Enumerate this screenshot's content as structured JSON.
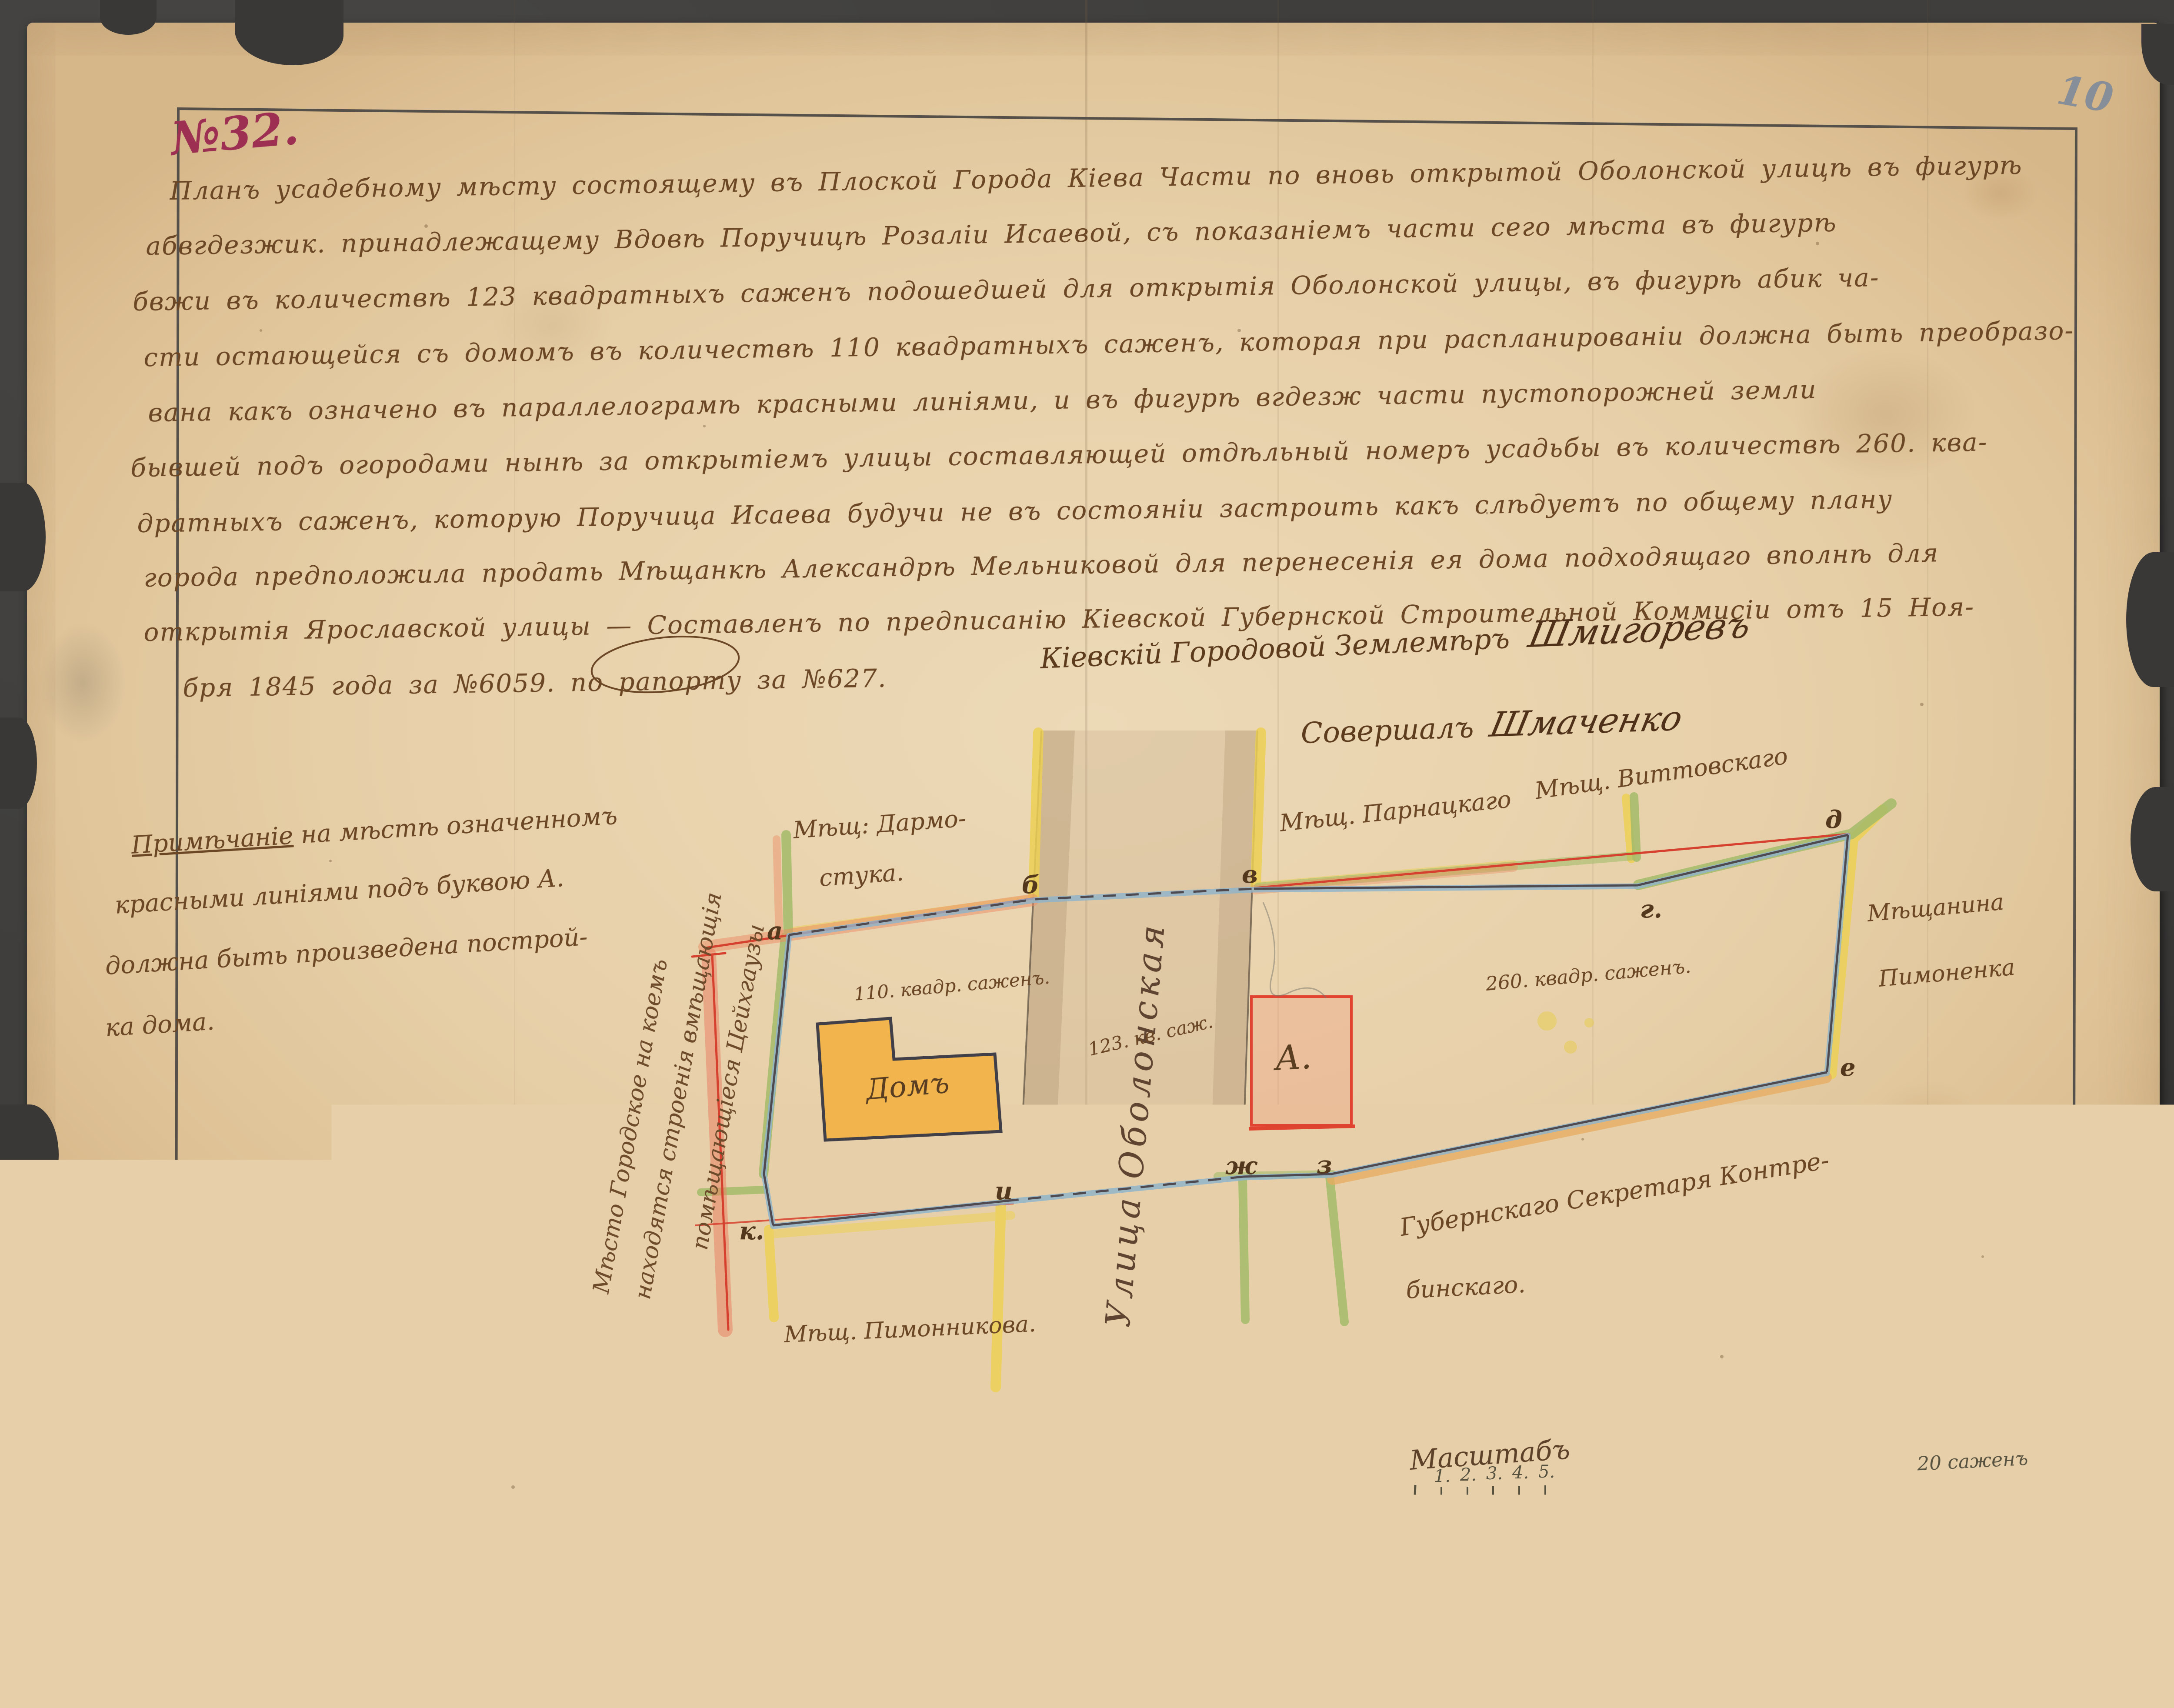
{
  "page": {
    "number": "10",
    "registry_number": "№32.",
    "pencil_bottom_left_1": "З",
    "pencil_bottom_left_2": "20"
  },
  "document": {
    "body_lines": [
      "Планъ усадебному мѣсту состоящему въ Плоской Города Кіева Части по вновь открытой Оболонской улицѣ въ фигурѣ",
      "абвгдезжик. принадлежащему Вдовѣ Поручицѣ Розаліи Исаевой, съ показаніемъ части сего мѣста въ фигурѣ",
      "бвжи въ количествѣ 123 квадратныхъ саженъ подошедшей для открытія Оболонской улицы, въ фигурѣ абик ча-",
      "сти остающейся съ домомъ въ количествѣ 110 квадратныхъ саженъ, которая при распланированіи должна быть преобразо-",
      "вана какъ означено въ параллелограмѣ красными линіями, и въ фигурѣ вгдезж части пустопорожней земли",
      "бывшей подъ огородами нынѣ за открытіемъ улицы составляющей отдѣльный номеръ усадьбы въ количествѣ 260. ква-",
      "дратныхъ саженъ, которую Поручица Исаева будучи не въ состояніи застроить какъ слѣдуетъ по общему плану",
      "города предположила продать Мѣщанкѣ Александрѣ Мельниковой для перенесенія ея дома подходящаго вполнѣ для",
      "открытія Ярославской улицы — Составленъ по предписанію Кіевской Губернской Строительной Коммисіи отъ 15 Ноя-",
      "бря 1845 года за №6059. по рапорту за №627."
    ]
  },
  "signatures": {
    "surveyor_role": "Кіевскій Городовой Землемѣръ",
    "surveyor_name": "Шмигоревъ",
    "second_role": "Совершалъ",
    "second_name": "Шмаченко"
  },
  "note": {
    "title": "Примѣчаніе",
    "line1_rest": " на мѣстѣ означенномъ",
    "line2": "красными линіями подъ буквою А.",
    "line3": "должна быть произведена построй-",
    "line4": "ка дома."
  },
  "side_caption": {
    "line1": "Мѣсто Городское на коемъ",
    "line2": "находятся строенія вмѣщающія",
    "line3": "помѣщающіеся Цейхгаузы"
  },
  "map": {
    "street_name": "Улица Оболонская",
    "house_label": "Домъ",
    "parcel_letter": "А.",
    "area_left": "110. квадр. саженъ.",
    "area_street": "123. кв. саж.",
    "area_right": "260. квадр. саженъ.",
    "neighbors": {
      "north_west_1": "Мѣщ: Дармо-",
      "north_west_2": "стука.",
      "north_1": "Мѣщ. Парнацкаго",
      "north_2": "Мѣщ. Виттовскаго",
      "east_1": "Мѣщанина",
      "east_2": "Пимоненка",
      "south_east_1": "Губернскаго Секретаря Контре-",
      "south_east_2": "бинскаго.",
      "south_west": "Мѣщ. Пимонникова."
    },
    "corners": {
      "a": "а",
      "b": "б",
      "v": "в",
      "g": "г.",
      "d": "д",
      "e": "е",
      "zh": "ж",
      "z": "з",
      "i": "и",
      "k": "к."
    },
    "scale": {
      "title": "Масштабъ",
      "t1": "1.",
      "t2": "2.",
      "t3": "3.",
      "t4": "4.",
      "t5": "5.",
      "t10": "10",
      "t15": "15",
      "end_label": "20 саженъ"
    }
  },
  "colors": {
    "ink": "#6b4726",
    "registry_red": "#9c2f52",
    "boundary_blue": "#8cb3cd",
    "boundary_green": "#a3bb6a",
    "boundary_yellow": "#ecd054",
    "boundary_orange": "#e8ab60",
    "red_line": "#d6402e",
    "parcel_a_fill": "#eea082",
    "house_fill": "#f2b54e",
    "street_tan": "#c4aa8a",
    "paper": "#e7d0a9"
  }
}
